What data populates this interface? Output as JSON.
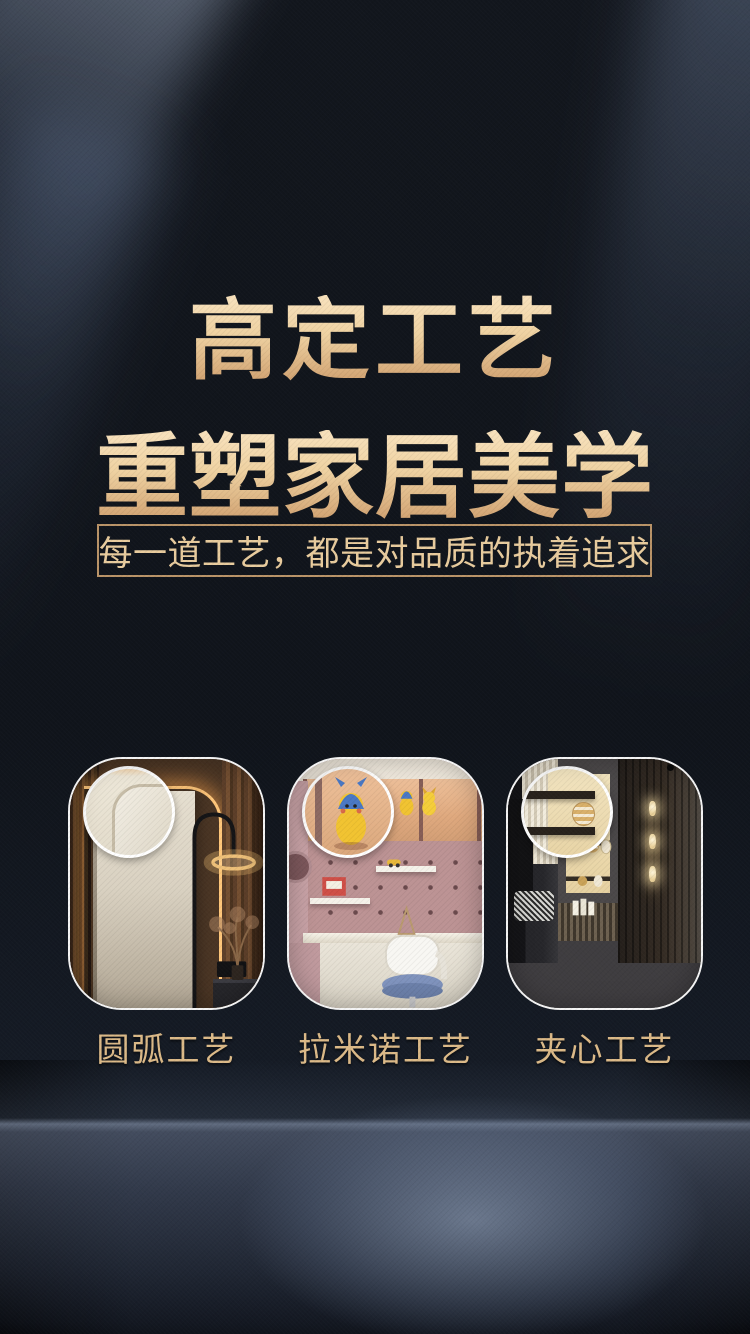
{
  "poster": {
    "title_line1": "高定工艺",
    "title_line2": "重塑家居美学",
    "subtitle": "每一道工艺，都是对品质的执着追求"
  },
  "cards": [
    {
      "label": "圆弧工艺",
      "scene": "bedroom rounded-corner panel with warm led strip, arc floor lamp and magnified corner detail"
    },
    {
      "label": "拉米诺工艺",
      "scene": "kids study room with pink pegboard, white desk and chair, shelf with pikachu figures, magnified figure detail"
    },
    {
      "label": "夹心工艺",
      "scene": "showroom wall with lit display shelves, vertical sconce, green marble base, magnified shelf detail"
    }
  ],
  "colors": {
    "gold_light": "#F7E0BA",
    "gold_dark": "#D2A473",
    "gold_text": "#E9CC9E",
    "gold_border": "#BA9468",
    "label_gold": "#DCBA88",
    "background_dark": "#10141B",
    "floor_glow_blue": "#A0B0CC"
  }
}
